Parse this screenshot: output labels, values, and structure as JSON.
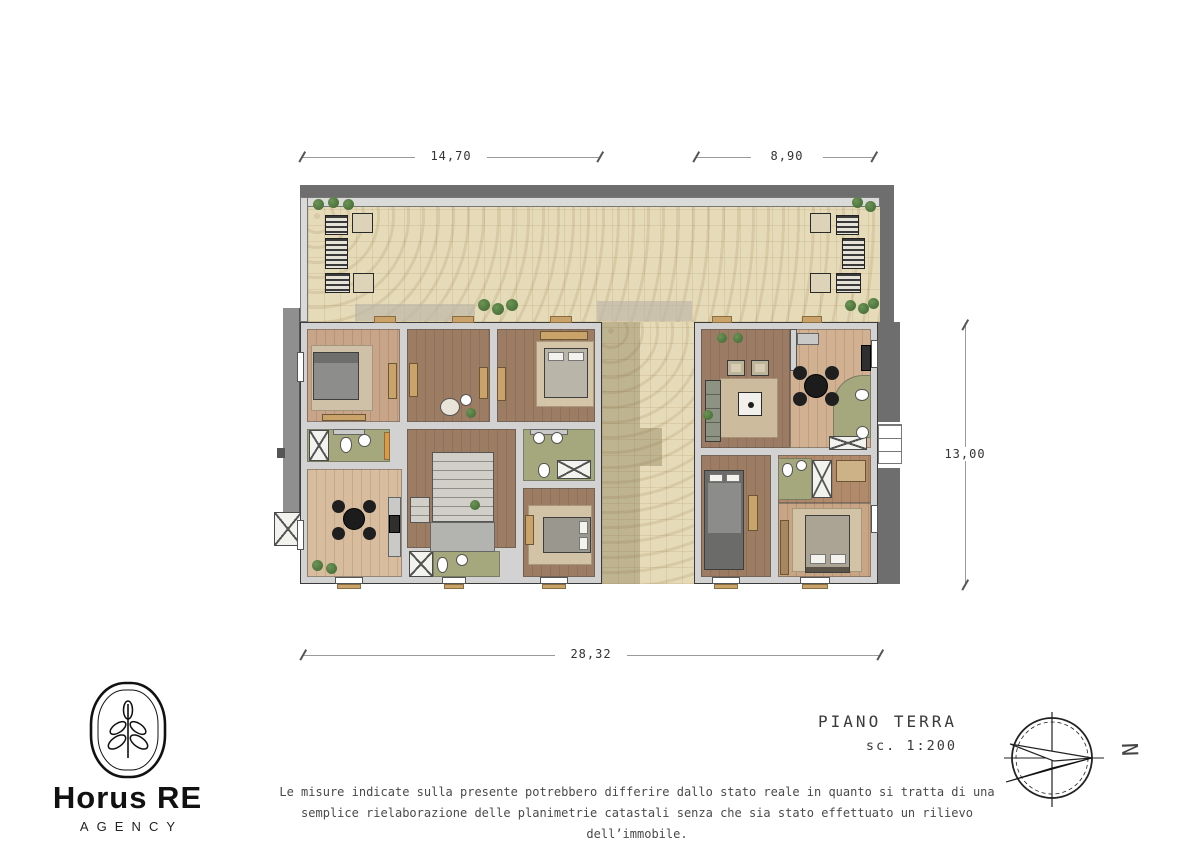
{
  "title_block": {
    "title": "PIANO TERRA",
    "scale": "sc. 1:200"
  },
  "logo": {
    "brand": "Horus RE",
    "subtitle": "AGENCY"
  },
  "compass": {
    "north_label": "N"
  },
  "dimensions": {
    "terrace_left": "14,70",
    "terrace_right": "8,90",
    "depth": "13,00",
    "total_width": "28,32"
  },
  "disclaimer": {
    "line1": "Le misure indicate sulla presente potrebbero differire dallo stato reale in quanto si tratta di una",
    "line2": "semplice rielaborazione delle planimetrie catastali senza che sia stato effettuato un rilievo dell’immobile."
  },
  "plan": {
    "floor": "PIANO TERRA",
    "areas": [
      "terrace",
      "courtyard",
      "stair-hall",
      "living-kitchen",
      "living-room",
      "dining-kitchen",
      "bedroom-1",
      "bedroom-2",
      "bedroom-3",
      "bedroom-4",
      "bedroom-5",
      "bedroom-6",
      "bathroom-1",
      "bathroom-2",
      "bathroom-3",
      "bathroom-4",
      "bathroom-5"
    ],
    "colors": {
      "tile": "#e6dbb8",
      "wall": "#d2d2d2",
      "wall_shadow": "#6e6e6e",
      "wood_light": "#d8bc9e",
      "wood_mid": "#c8a488",
      "wood_dark": "#9d7c64",
      "bathroom_green": "#a4a87c",
      "accent_orange": "#dd9a45",
      "furniture_black": "#1c1c1c"
    }
  }
}
